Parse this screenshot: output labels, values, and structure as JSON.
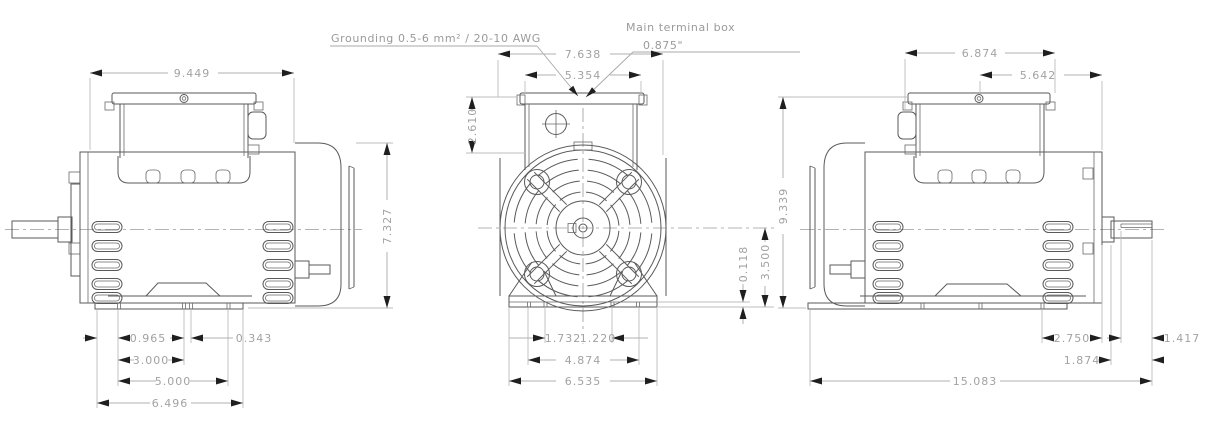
{
  "drawing_title": "Electric motor outline dimensional drawing - three views",
  "annotations": {
    "grounding_label": "Grounding 0.5-6 mm² / 20-10 AWG",
    "terminal_box_label": "Main terminal box",
    "terminal_box_hole": "0.875\""
  },
  "views": {
    "left": {
      "dims": {
        "overall_length": "9.449",
        "cover_height": "7.327",
        "foot_hole_offset": "0.965",
        "vent_slot": "0.343",
        "mount_span_a": "3.000",
        "mount_span_b": "5.000",
        "base_length": "6.496"
      }
    },
    "front": {
      "dims": {
        "overall_width": "7.638",
        "lid_width": "5.354",
        "box_height": "2.610",
        "foot_left": "1.732",
        "foot_right": "1.220",
        "mount_span": "4.874",
        "base_width": "6.535",
        "pad_thickness": "0.118",
        "shaft_height": "3.500"
      }
    },
    "right": {
      "dims": {
        "box_width": "6.874",
        "box_to_face": "5.642",
        "overall_height": "9.339",
        "rear_overhang": "2.750",
        "key_length": "1.417",
        "shaft_length": "1.874",
        "overall_length": "15.083"
      }
    }
  }
}
